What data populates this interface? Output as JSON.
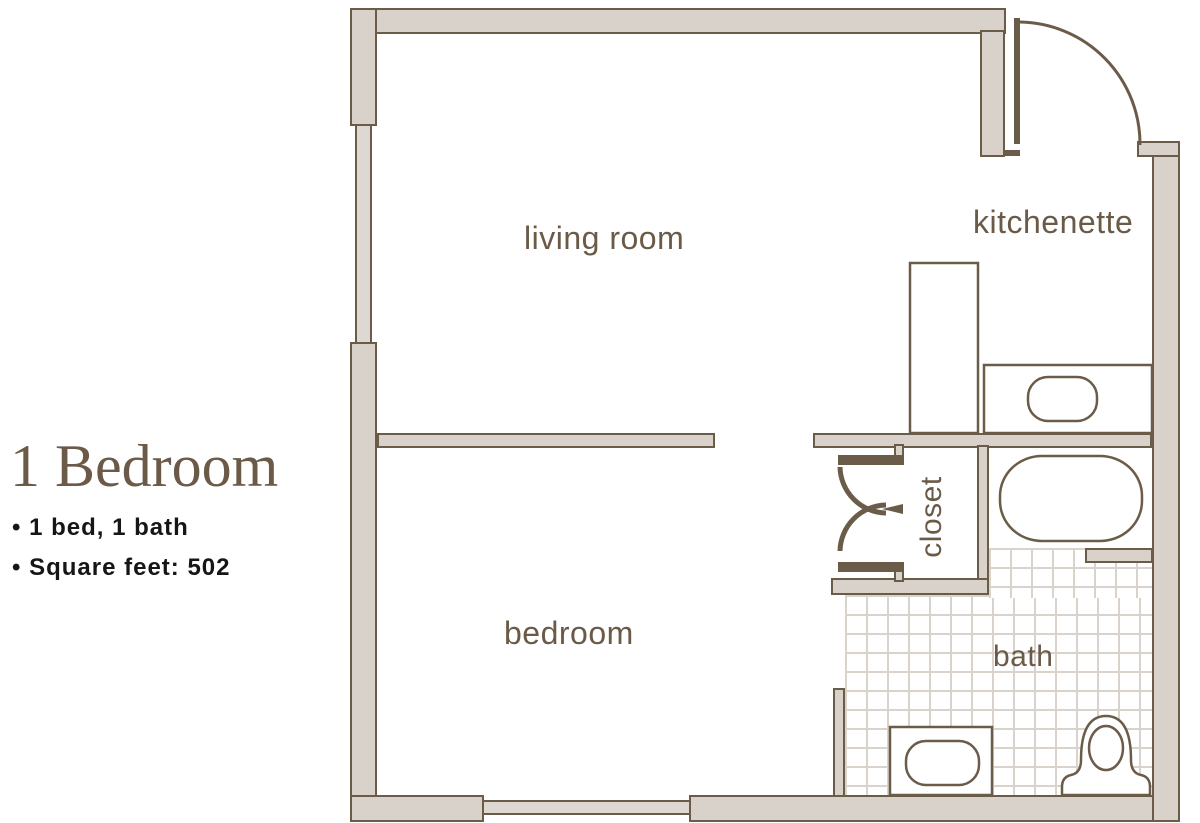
{
  "info": {
    "title": "1 Bedroom",
    "bullets": [
      "• 1 bed, 1 bath",
      "• Square feet: 502"
    ]
  },
  "floorplan": {
    "labels": {
      "living_room": "living room",
      "kitchenette": "kitchenette",
      "closet": "closet",
      "bedroom": "bedroom",
      "bath": "bath"
    },
    "fixtures": [
      "entry-door",
      "closet-double-doors",
      "kitchen-cabinet",
      "kitchen-counter",
      "kitchen-sink",
      "bathtub",
      "toilet",
      "pedestal-sink",
      "tiled-bath-floor",
      "window-left",
      "window-bottom"
    ]
  },
  "colors": {
    "wall_fill": "#d8d2cb",
    "wall_outline": "#6b5c49",
    "room_label": "#6a5a47",
    "tile_line": "#d9d3cb",
    "heading_text": "#6b5a48",
    "body_text": "#161616",
    "background": "#ffffff"
  }
}
